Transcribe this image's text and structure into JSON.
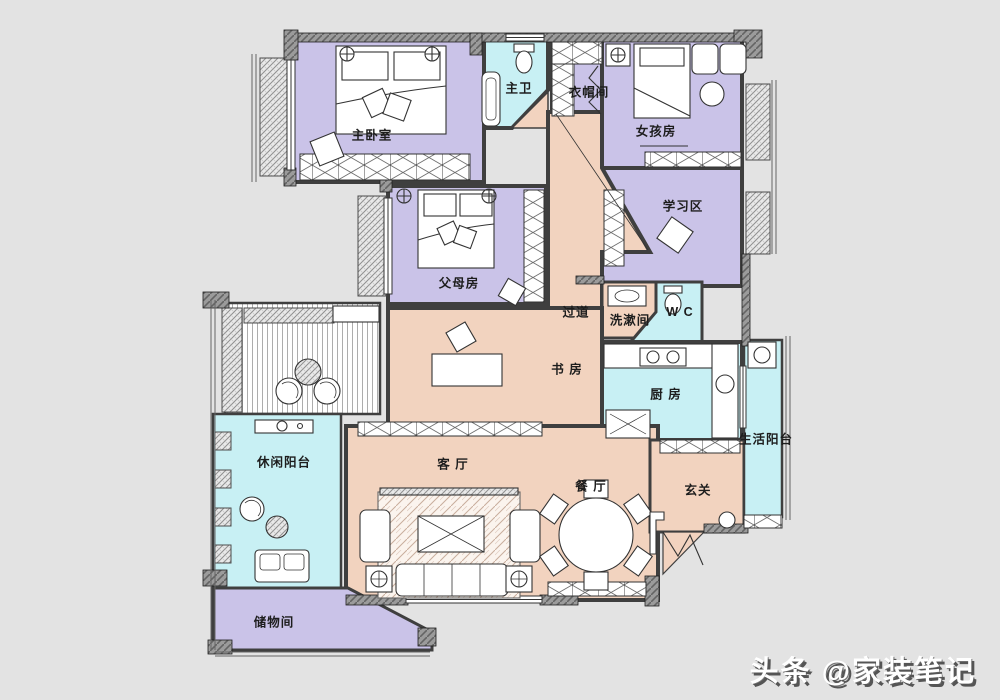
{
  "plan": {
    "type": "apartment-floor-plan",
    "colors": {
      "background": "#e3e3e3",
      "bedroom_fill": "#cac3e8",
      "public_fill": "#f2d3bf",
      "wet_fill": "#c8f0f4",
      "wall": "#8f8f8f",
      "label_text": "#1d1d1d"
    },
    "rooms": [
      {
        "id": "master-bedroom",
        "label": "主卧室"
      },
      {
        "id": "master-bath",
        "label": "主卫"
      },
      {
        "id": "cloakroom",
        "label": "衣帽间"
      },
      {
        "id": "girls-room",
        "label": "女孩房"
      },
      {
        "id": "study-area",
        "label": "学习区"
      },
      {
        "id": "parents-room",
        "label": "父母房"
      },
      {
        "id": "corridor",
        "label": "过道"
      },
      {
        "id": "washroom",
        "label": "洗漱间"
      },
      {
        "id": "wc",
        "label": "W C"
      },
      {
        "id": "kitchen",
        "label": "厨 房"
      },
      {
        "id": "den",
        "label": "书 房"
      },
      {
        "id": "leisure-balcony",
        "label": "休闲阳台"
      },
      {
        "id": "living-room",
        "label": "客 厅"
      },
      {
        "id": "dining-room",
        "label": "餐 厅"
      },
      {
        "id": "entry",
        "label": "玄关"
      },
      {
        "id": "life-balcony",
        "label": "生活阳台"
      },
      {
        "id": "storage",
        "label": "储物间"
      }
    ]
  },
  "watermark": {
    "text": "头条 @家装笔记"
  }
}
